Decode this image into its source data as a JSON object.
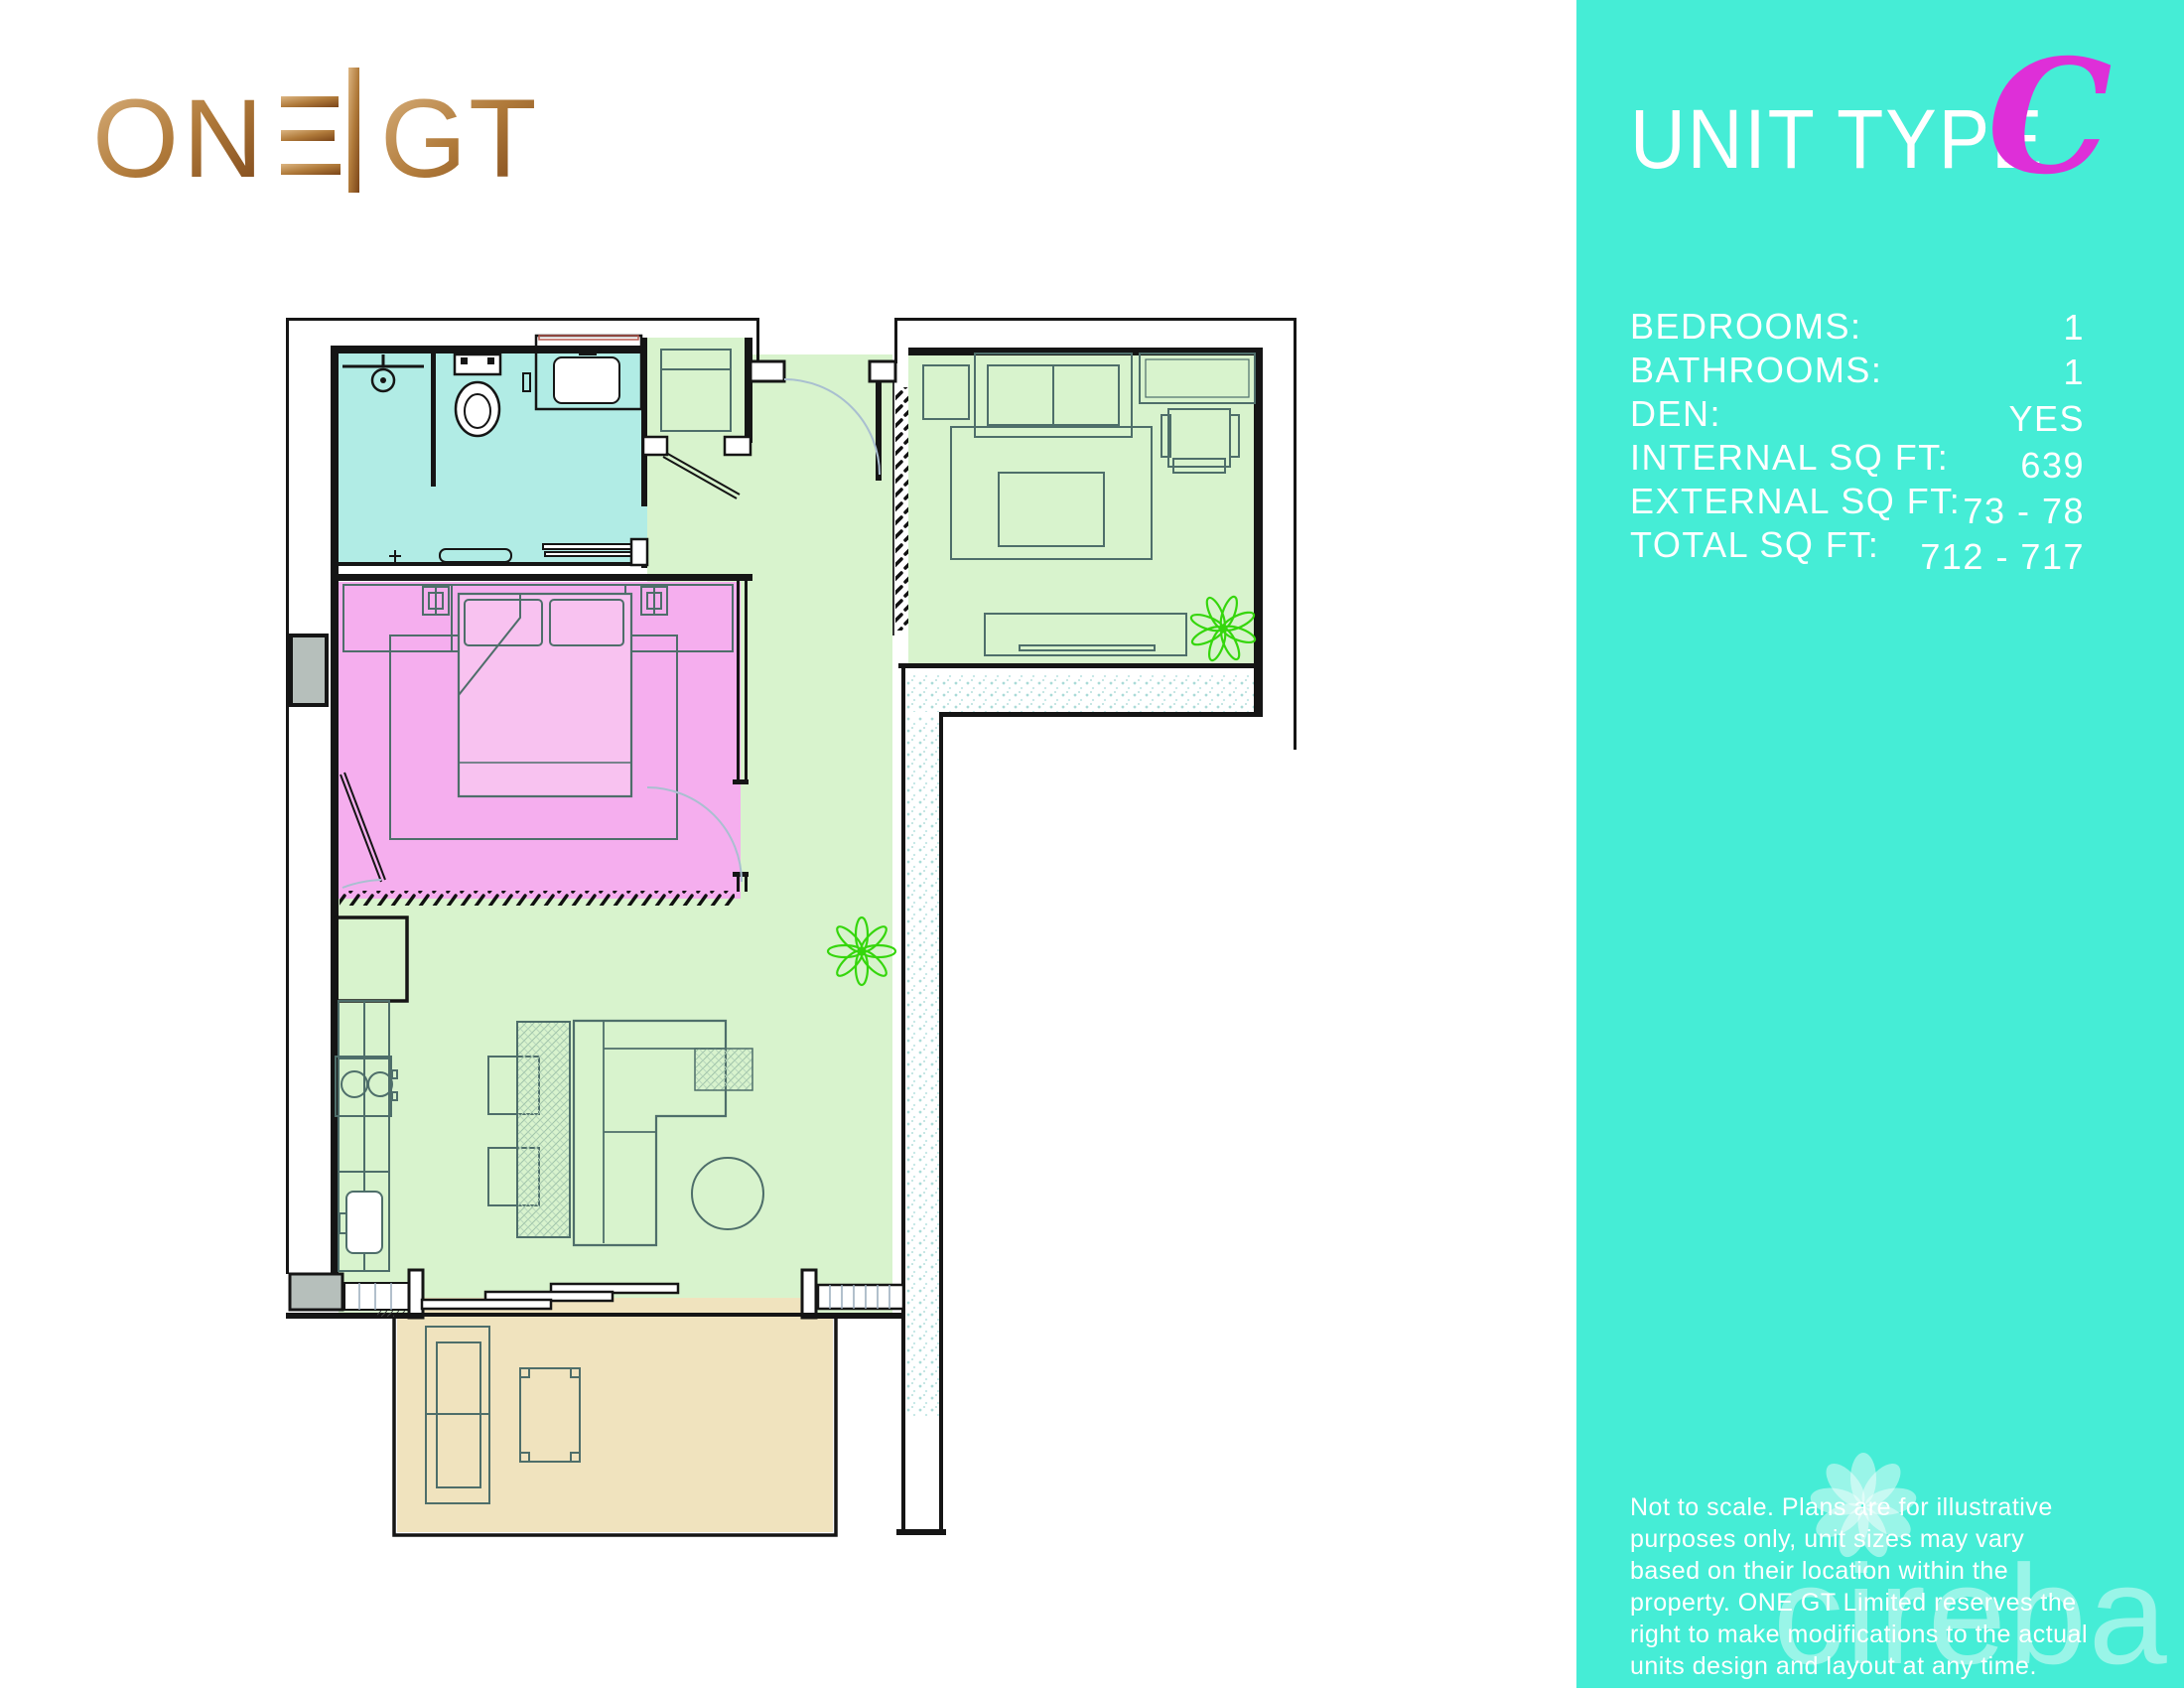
{
  "logo": {
    "full": "ONE|GT",
    "prefix": "ON",
    "suffix": "GT"
  },
  "panel": {
    "bg_color": "#45edd6",
    "title": "UNIT TYPE",
    "unit_letter": "C",
    "unit_letter_color": "#de2fd8",
    "specs": [
      {
        "label": "BEDROOMS:",
        "value": "1"
      },
      {
        "label": "BATHROOMS:",
        "value": "1"
      },
      {
        "label": "DEN:",
        "value": "YES"
      },
      {
        "label": "INTERNAL SQ FT:",
        "value": "639"
      },
      {
        "label": "EXTERNAL SQ FT:",
        "value": "73 - 78"
      },
      {
        "label": "TOTAL SQ FT:",
        "value": "712 - 717"
      }
    ],
    "disclaimer": "Not to scale. Plans are for illustrative purposes only, unit sizes may vary based on their location within the property. ONE GT Limited reserves the right to make modifications to the actual units design and layout at any time.",
    "watermark": "cireba"
  },
  "floorplan": {
    "colors": {
      "bathroom": "#b1ece5",
      "bedroom": "#f5aeee",
      "bed": "#f8c2f0",
      "living_den": "#d8f3cd",
      "balcony": "#f0e3be",
      "plant": "#35d60c",
      "wall": "#151515",
      "furniture_line": "#4e6e6a"
    }
  }
}
